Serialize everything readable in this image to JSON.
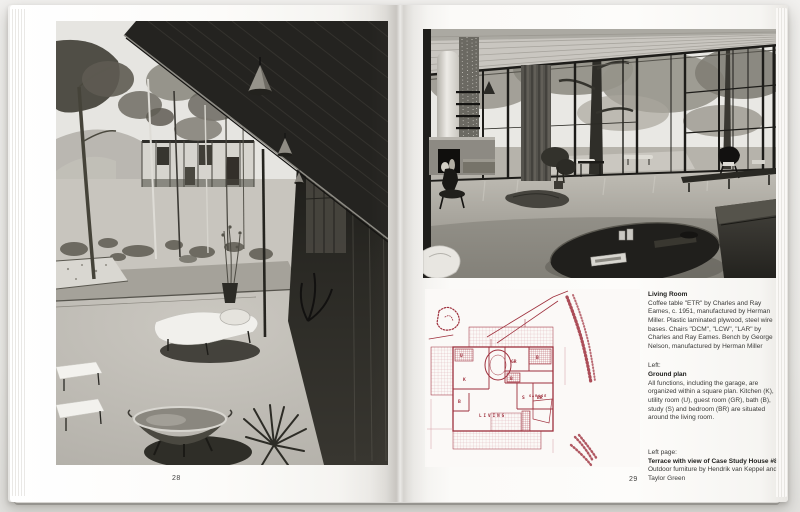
{
  "colors": {
    "plan_ink": "#9e2f3c",
    "plan_ink_light": "#d39aa2",
    "paper": "#fbfaf8"
  },
  "left_page": {
    "page_number": "28"
  },
  "right_page": {
    "page_number": "29",
    "captions": {
      "living_room": {
        "heading": "Living Room",
        "body": "Coffee table \"ETR\" by Charles and Ray Eames, c. 1951, manufactured by Herman Miller. Plastic laminated plywood, steel wire bases. Chairs \"DCM\", \"LCW\", \"LAR\" by Charles and Ray Eames. Bench by George Nelson, manufactured by Herman Miller"
      },
      "ground_plan": {
        "ref": "Left:",
        "heading": "Ground plan",
        "body": "All functions, including the garage, are organized within a square plan. Kitchen (K), utility room (U), guest room (GR), bath (B), study (S) and bedroom (BR) are situated around the living room."
      },
      "terrace": {
        "ref": "Left page:",
        "heading": "Terrace with view of Case Study House #8",
        "body": "Outdoor furniture by Hendrik van Keppel and Taylor Green"
      }
    },
    "plan_labels": {
      "utility": "U",
      "kitchen": "K",
      "guest": "GR",
      "bath_top": "B",
      "bath_small": "B",
      "bath_left": "B",
      "study": "S",
      "bedroom": "BR",
      "living": "LIVING",
      "garage": "GARAGE"
    }
  }
}
